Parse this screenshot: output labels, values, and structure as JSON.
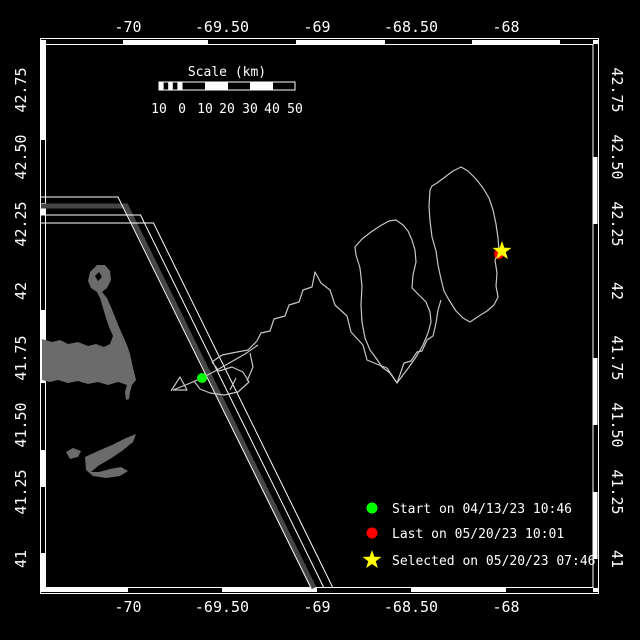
{
  "map": {
    "axes": {
      "top": [
        "-70",
        "-69.50",
        "-69",
        "-68.50",
        "-68"
      ],
      "bottom": [
        "-70",
        "-69.50",
        "-69",
        "-68.50",
        "-68"
      ],
      "left": [
        "42.75",
        "42.50",
        "42.25",
        "42",
        "41.75",
        "41.50",
        "41.25",
        "41"
      ],
      "right": [
        "42.75",
        "42.50",
        "42.25",
        "42",
        "41.75",
        "41.50",
        "41.25",
        "41"
      ]
    },
    "scale_bar": {
      "title": "Scale (km)",
      "ticks": [
        "10",
        "0",
        "10",
        "20",
        "30",
        "40",
        "50"
      ]
    },
    "legend": {
      "items": [
        {
          "id": "start",
          "marker": "circle",
          "color": "#00ff00",
          "label": "Start on 04/13/23 10:46"
        },
        {
          "id": "last",
          "marker": "circle",
          "color": "#ff0000",
          "label": "Last on 05/20/23 10:01"
        },
        {
          "id": "selected",
          "marker": "star",
          "color": "#ffff00",
          "label": "Selected on 05/20/23 07:46"
        }
      ]
    },
    "colors": {
      "background": "#000000",
      "frame": "#ffffff",
      "track": "#c6c6c6",
      "land": "#6b6b6b",
      "shipping_lane": "#464646",
      "start_marker": "#00ff00",
      "last_marker": "#ff0000",
      "selected_marker": "#ffff00"
    }
  }
}
